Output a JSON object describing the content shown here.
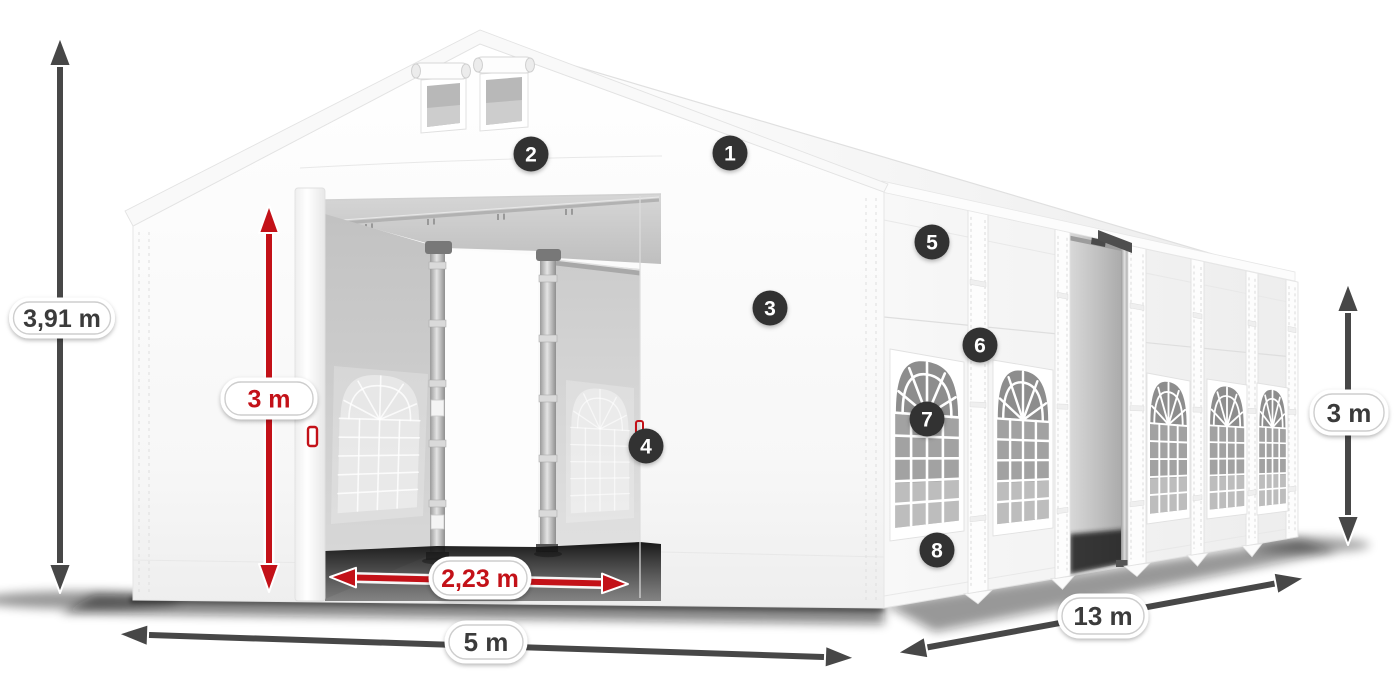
{
  "diagram": {
    "type": "tent-dimension-diagram"
  },
  "dimensions": {
    "total_height": {
      "label": "3,91 m"
    },
    "entrance_height": {
      "label": "3 m"
    },
    "entrance_width": {
      "label": "2,23 m"
    },
    "front_width": {
      "label": "5 m"
    },
    "side_length": {
      "label": "13 m"
    },
    "wall_height": {
      "label": "3 m"
    }
  },
  "markers": [
    {
      "number": "1"
    },
    {
      "number": "2"
    },
    {
      "number": "3"
    },
    {
      "number": "4"
    },
    {
      "number": "5"
    },
    {
      "number": "6"
    },
    {
      "number": "7"
    },
    {
      "number": "8"
    }
  ],
  "colors": {
    "dimension_red": "#c31118",
    "dimension_gray": "#474747",
    "marker_background": "#333333",
    "label_text": "#3b3b3b",
    "tent_fabric": "#ffffff"
  }
}
